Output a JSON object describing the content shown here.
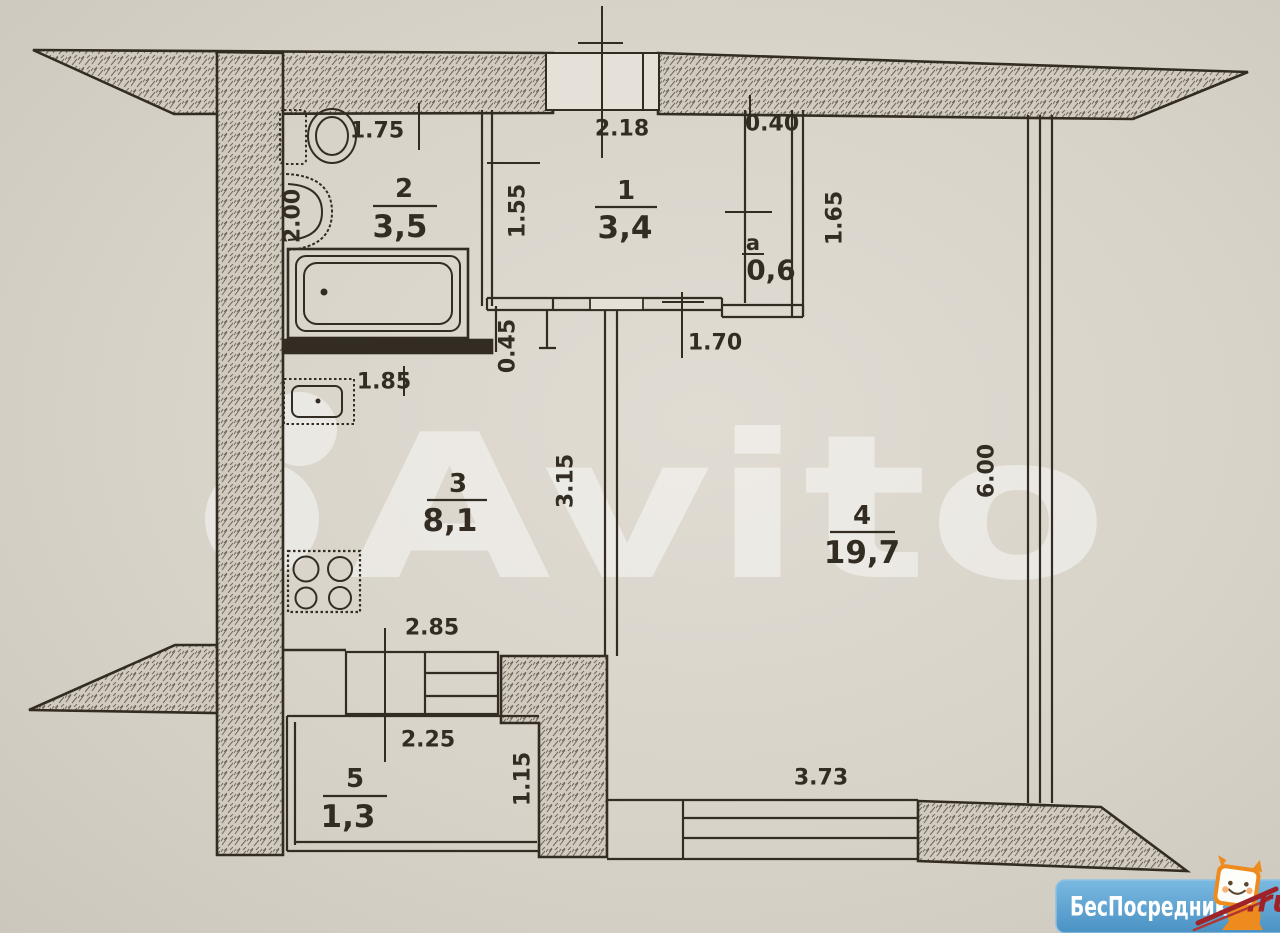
{
  "document": {
    "type": "apartment floor plan (scanned drawing)"
  },
  "watermark": {
    "brand": "Avito"
  },
  "logo": {
    "site_name": "БесПосредника",
    "domain_suffix": ".ru"
  },
  "rooms": [
    {
      "id": "1",
      "area": "3,4"
    },
    {
      "id": "2",
      "area": "3,5"
    },
    {
      "id": "3",
      "area": "8,1"
    },
    {
      "id": "4",
      "area": "19,7"
    },
    {
      "id": "5",
      "area": "1,3"
    },
    {
      "id": "а",
      "area": "0,6"
    }
  ],
  "dimensions_m": [
    {
      "value": "1.75"
    },
    {
      "value": "2.00"
    },
    {
      "value": "1.55"
    },
    {
      "value": "2.18"
    },
    {
      "value": "0.40"
    },
    {
      "value": "1.65"
    },
    {
      "value": "1.70"
    },
    {
      "value": "0.45"
    },
    {
      "value": "1.85"
    },
    {
      "value": "3.15"
    },
    {
      "value": "2.85"
    },
    {
      "value": "2.25"
    },
    {
      "value": "1.15"
    },
    {
      "value": "3.73"
    },
    {
      "value": "6.00"
    }
  ],
  "fixtures": [
    "toilet",
    "wash-basin",
    "bathtub",
    "kitchen-sink",
    "stove",
    "window",
    "balcony-door"
  ],
  "colors": {
    "ink": "#332c23",
    "paper": "#d8d3c9",
    "watermark": "#ffffff",
    "logo_blue": "#5aa5d3",
    "logo_orange": "#ee8b1f",
    "logo_red": "#9e2227"
  }
}
